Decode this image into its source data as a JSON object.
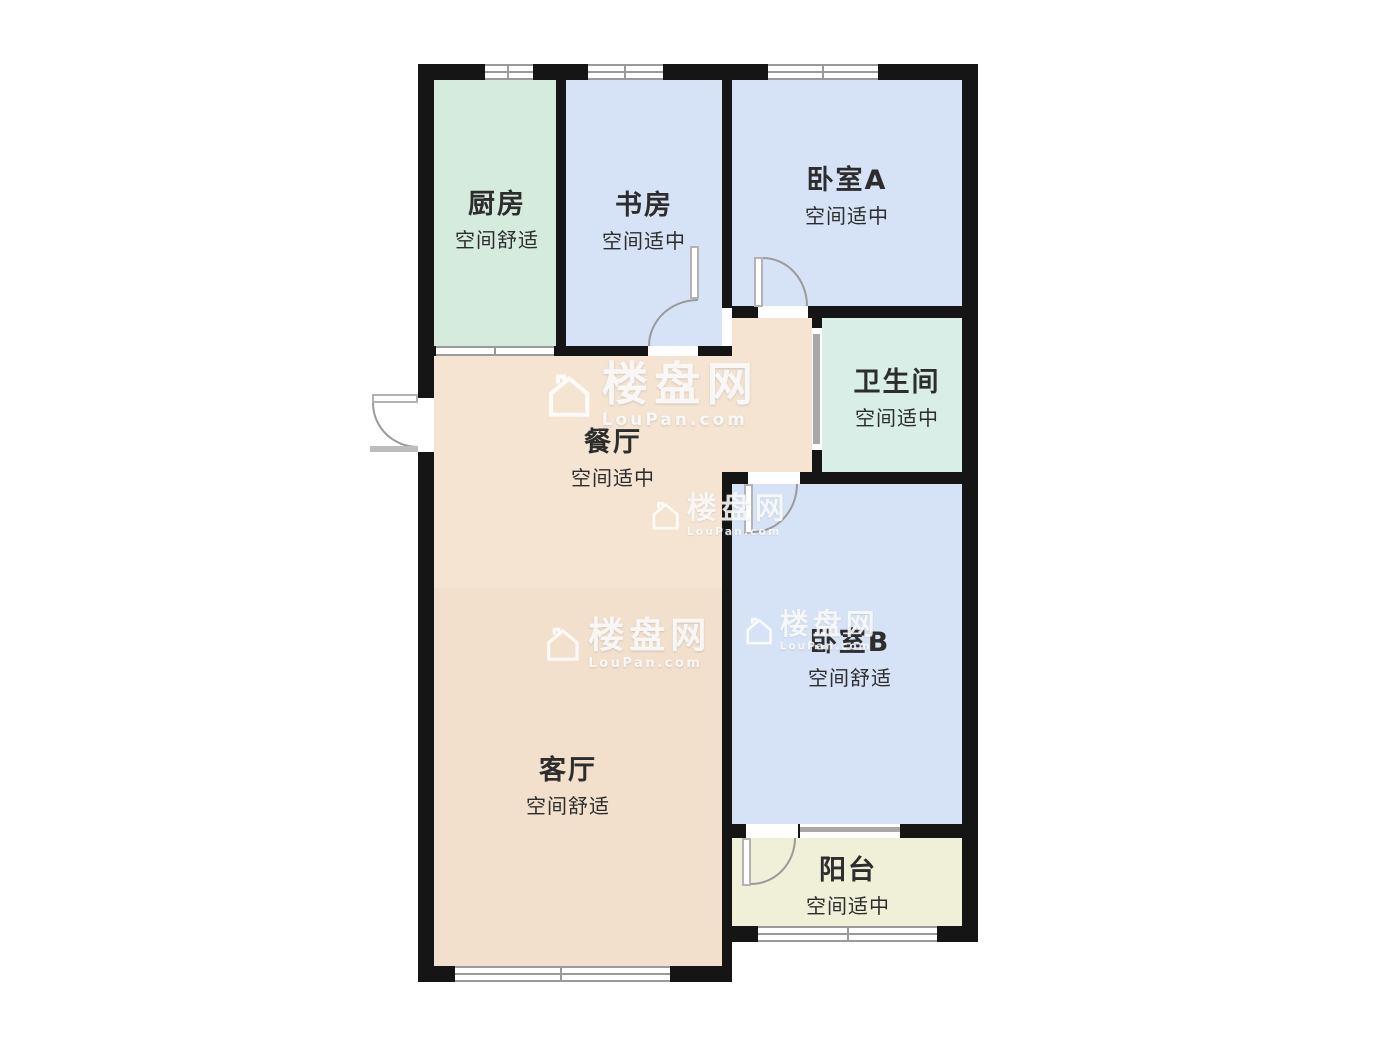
{
  "plan": {
    "rooms": [
      {
        "id": "kitchen",
        "name": "厨房",
        "subtitle": "空间舒适",
        "fill": "#d5ebde"
      },
      {
        "id": "study",
        "name": "书房",
        "subtitle": "空间适中",
        "fill": "#d6e3f6"
      },
      {
        "id": "bedroom-a",
        "name": "卧室A",
        "subtitle": "空间适中",
        "fill": "#d6e3f6"
      },
      {
        "id": "bathroom",
        "name": "卫生间",
        "subtitle": "空间适中",
        "fill": "#d8eee6"
      },
      {
        "id": "dining",
        "name": "餐厅",
        "subtitle": "空间适中",
        "fill": "#f5e4d2"
      },
      {
        "id": "bedroom-b",
        "name": "卧室B",
        "subtitle": "空间舒适",
        "fill": "#d6e3f6"
      },
      {
        "id": "living",
        "name": "客厅",
        "subtitle": "空间舒适",
        "fill": "#f2dfcc"
      },
      {
        "id": "balcony",
        "name": "阳台",
        "subtitle": "空间适中",
        "fill": "#f0efd8"
      }
    ],
    "watermark": {
      "brand": "楼盘网",
      "domain": "LouPan.com"
    },
    "colors": {
      "wall": "#151515",
      "glazing": "#9a9a9a",
      "kitchen_bath_green": "#d6ecE2",
      "bedroom_blue": "#d6e3f6",
      "dining_tan": "#f5e4d2",
      "living_tan": "#f2dfcc",
      "balcony_cream": "#f0efd8"
    }
  }
}
